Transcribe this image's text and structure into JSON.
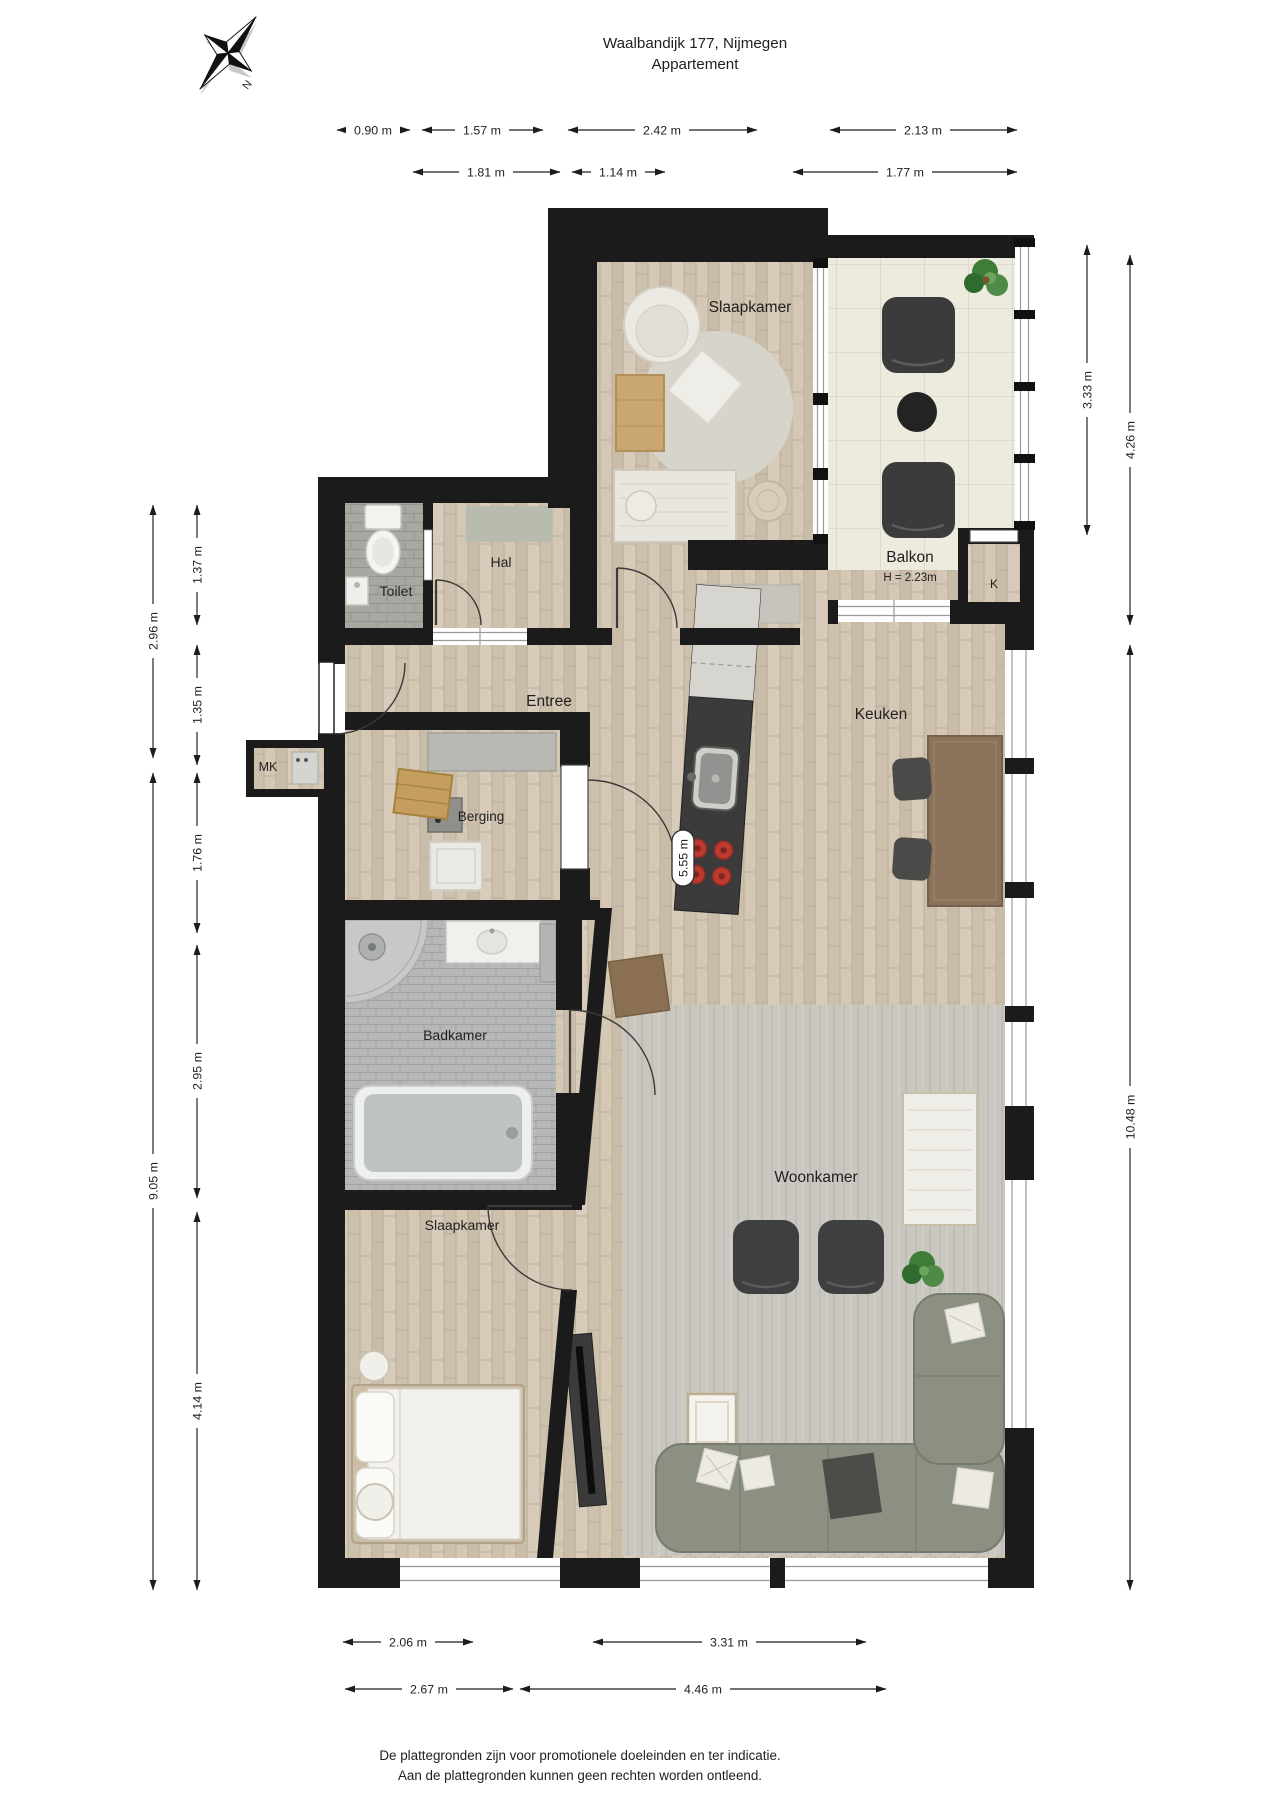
{
  "title": {
    "line1": "Waalbandijk 177,  Nijmegen",
    "line2": "Appartement"
  },
  "compass": {
    "north_label": "N"
  },
  "rooms": {
    "slaapkamer_top": {
      "label": "Slaapkamer"
    },
    "balkon": {
      "label": "Balkon",
      "height_note": "H = 2.23m"
    },
    "kast": {
      "label": "K"
    },
    "toilet": {
      "label": "Toilet"
    },
    "hal": {
      "label": "Hal"
    },
    "entree": {
      "label": "Entree",
      "height_note": "H = 2.46m"
    },
    "keuken": {
      "label": "Keuken"
    },
    "meterkast": {
      "label": "MK"
    },
    "berging": {
      "label": "Berging"
    },
    "badkamer": {
      "label": "Badkamer"
    },
    "woonkamer": {
      "label": "Woonkamer"
    },
    "slaapkamer_bottom": {
      "label": "Slaapkamer"
    }
  },
  "dimensions": {
    "top_row1": [
      "0.90 m",
      "1.57 m",
      "2.42 m",
      "2.13 m"
    ],
    "top_row2": [
      "1.81 m",
      "1.14 m",
      "1.77 m"
    ],
    "left_outer": [
      "2.96 m",
      "9.05 m"
    ],
    "left_inner": [
      "1.37 m",
      "1.35 m",
      "1.76 m",
      "2.95 m",
      "4.14 m"
    ],
    "right_inner": [
      "3.33 m"
    ],
    "right_outer": [
      "4.26 m",
      "10.48 m"
    ],
    "bottom_row1": [
      "2.06 m",
      "3.31 m"
    ],
    "bottom_row2": [
      "2.67 m",
      "4.46 m"
    ],
    "kitchen_island": "5.55 m"
  },
  "footer": {
    "line1": "De plattegronden zijn voor promotionele doeleinden en ter indicatie.",
    "line2": "Aan de plattegronden kunnen geen rechten worden ontleend."
  },
  "colors": {
    "wall": "#1b1b1b",
    "wood_floor": "#d2c5b2",
    "balcony_tile": "#edeade",
    "bathroom_tile": "#b5b8b6",
    "stove_burner": "#bf3a2e",
    "sofa": "#8b9083",
    "plant": "#3e7c38"
  }
}
